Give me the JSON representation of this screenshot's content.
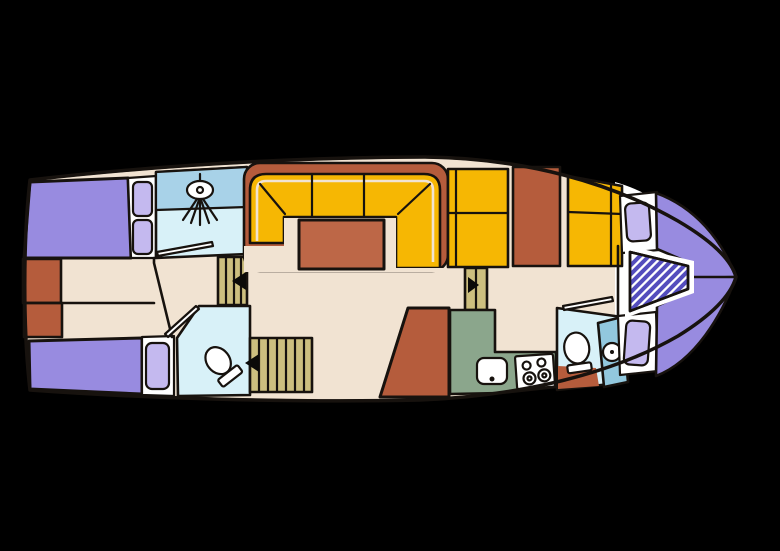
{
  "diagram": {
    "kind": "boat-floor-plan",
    "background": "#000000"
  },
  "colors": {
    "outline": "#17120e",
    "floor": "#f1e3d2",
    "white": "#ffffff",
    "bed_purple": "#988be0",
    "pillow_purple": "#c4b9ef",
    "rust": "#b55c3c",
    "rust_light": "#bd6747",
    "yellow": "#f6b703",
    "stair_tan": "#cdbf7f",
    "shower_blue": "#a8d2e8",
    "pale_blue": "#d8f1f8",
    "sink_blue": "#92c8de",
    "galley_green": "#8ba68c",
    "hatch_stripe": "#544dbd",
    "arrow_black": "#0b0a08"
  },
  "icons": {
    "shower_head": "shower-head-icon",
    "toilet_aft": "toilet-icon",
    "toilet_forward": "toilet-icon",
    "basin": "sink-icon",
    "galley_sink": "sink-icon",
    "stove": "stove-burners-icon",
    "arrow_aft_stairs": "direction-arrow-left",
    "arrow_mid_stairs": "direction-arrow-left",
    "arrow_fore_steps": "direction-arrow-right"
  }
}
